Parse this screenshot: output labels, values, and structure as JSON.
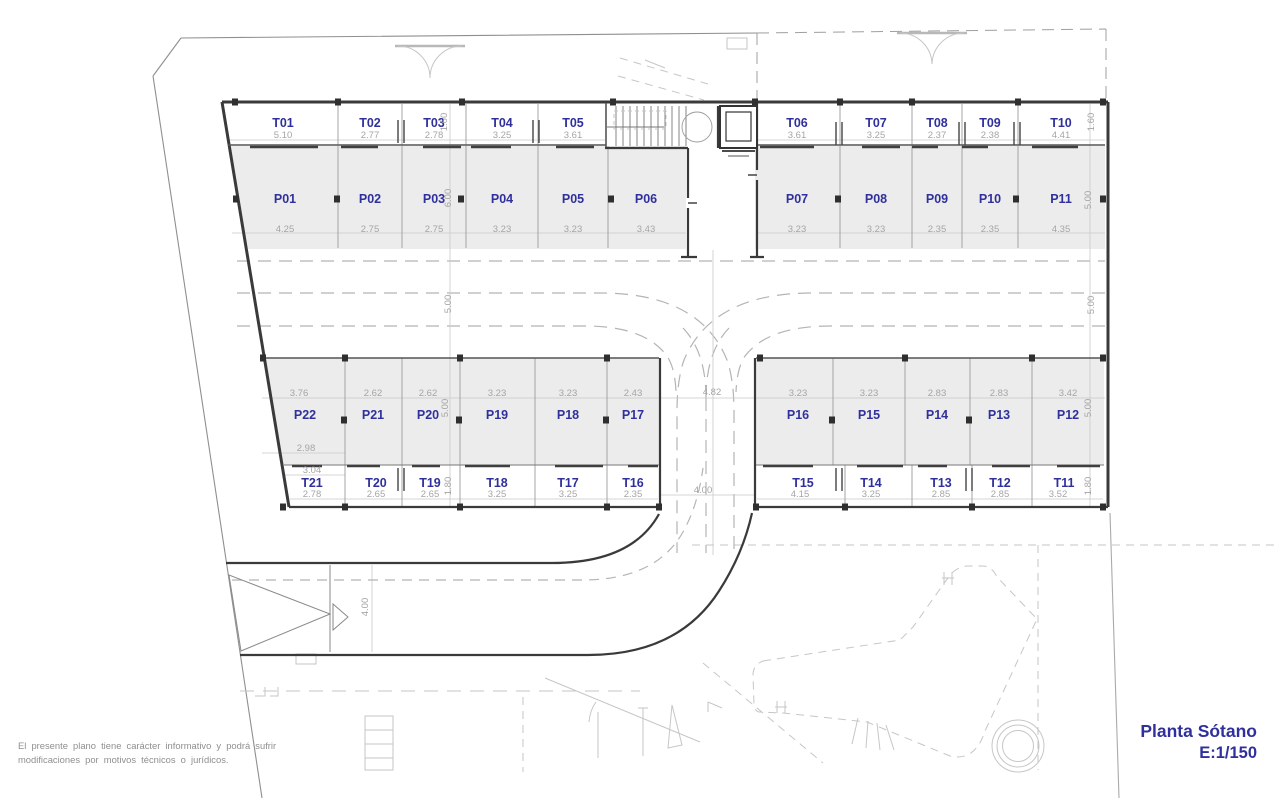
{
  "title_block": {
    "title": "Planta Sótano",
    "scale": "E:1/150"
  },
  "disclaimer": {
    "line1": "El presente plano tiene carácter informativo y podrá sufrir",
    "line2": "modificaciones por motivos técnicos o jurídicos."
  },
  "colors": {
    "label_blue": "#30309c",
    "dim_gray": "#a5a5a5",
    "wall_dark": "#3a3a3a",
    "stall_fill": "#ececec",
    "line_gray": "#9c9c9c",
    "light_gray": "#c6c6c6"
  },
  "plan": {
    "rows": [
      {
        "name": "storage-top",
        "label_y": 127,
        "dim_y": 138,
        "stalls": [
          {
            "id": "T01",
            "dim": "5.10",
            "x": 283
          },
          {
            "id": "T02",
            "dim": "2.77",
            "x": 370
          },
          {
            "id": "T03",
            "dim": "2.78",
            "x": 434
          },
          {
            "id": "T04",
            "dim": "3.25",
            "x": 502
          },
          {
            "id": "T05",
            "dim": "3.61",
            "x": 573
          },
          {
            "id": "T06",
            "dim": "3.61",
            "x": 797
          },
          {
            "id": "T07",
            "dim": "3.25",
            "x": 876
          },
          {
            "id": "T08",
            "dim": "2.37",
            "x": 937
          },
          {
            "id": "T09",
            "dim": "2.38",
            "x": 990
          },
          {
            "id": "T10",
            "dim": "4.41",
            "x": 1061
          }
        ]
      },
      {
        "name": "parking-top",
        "label_y": 203,
        "dim_y": 232,
        "stalls": [
          {
            "id": "P01",
            "dim": "4.25",
            "x": 285
          },
          {
            "id": "P02",
            "dim": "2.75",
            "x": 370
          },
          {
            "id": "P03",
            "dim": "2.75",
            "x": 434
          },
          {
            "id": "P04",
            "dim": "3.23",
            "x": 502
          },
          {
            "id": "P05",
            "dim": "3.23",
            "x": 573
          },
          {
            "id": "P06",
            "dim": "3.43",
            "x": 646
          },
          {
            "id": "P07",
            "dim": "3.23",
            "x": 797
          },
          {
            "id": "P08",
            "dim": "3.23",
            "x": 876
          },
          {
            "id": "P09",
            "dim": "2.35",
            "x": 937
          },
          {
            "id": "P10",
            "dim": "2.35",
            "x": 990
          },
          {
            "id": "P11",
            "dim": "4.35",
            "x": 1061
          }
        ]
      },
      {
        "name": "parking-bottom",
        "label_y": 419,
        "dim_y": 396,
        "stalls": [
          {
            "id": "P22",
            "dim": "3.76",
            "x": 305,
            "dim_x": 299
          },
          {
            "id": "P21",
            "dim": "2.62",
            "x": 373
          },
          {
            "id": "P20",
            "dim": "2.62",
            "x": 428
          },
          {
            "id": "P19",
            "dim": "3.23",
            "x": 497
          },
          {
            "id": "P18",
            "dim": "3.23",
            "x": 568
          },
          {
            "id": "P17",
            "dim": "2.43",
            "x": 633
          },
          {
            "id": "P16",
            "dim": "3.23",
            "x": 798
          },
          {
            "id": "P15",
            "dim": "3.23",
            "x": 869
          },
          {
            "id": "P14",
            "dim": "2.83",
            "x": 937
          },
          {
            "id": "P13",
            "dim": "2.83",
            "x": 999
          },
          {
            "id": "P12",
            "dim": "3.42",
            "x": 1068
          }
        ]
      },
      {
        "name": "storage-bottom",
        "label_y": 487,
        "dim_y": 497,
        "stalls": [
          {
            "id": "T21",
            "dim": "2.78",
            "x": 312
          },
          {
            "id": "T20",
            "dim": "2.65",
            "x": 376
          },
          {
            "id": "T19",
            "dim": "2.65",
            "x": 430
          },
          {
            "id": "T18",
            "dim": "3.25",
            "x": 497
          },
          {
            "id": "T17",
            "dim": "3.25",
            "x": 568
          },
          {
            "id": "T16",
            "dim": "2.35",
            "x": 633
          },
          {
            "id": "T15",
            "dim": "4.15",
            "x": 803,
            "dim_x": 800
          },
          {
            "id": "T14",
            "dim": "3.25",
            "x": 871
          },
          {
            "id": "T13",
            "dim": "2.85",
            "x": 941
          },
          {
            "id": "T12",
            "dim": "2.85",
            "x": 1000
          },
          {
            "id": "T11",
            "dim": "3.52",
            "x": 1064,
            "dim_x": 1058
          }
        ]
      }
    ],
    "dim_labels": [
      {
        "t": "1.60",
        "x": 447,
        "y": 122,
        "r": 1
      },
      {
        "t": "6.00",
        "x": 451,
        "y": 198,
        "r": 1
      },
      {
        "t": "5.00",
        "x": 451,
        "y": 304,
        "r": 1
      },
      {
        "t": "5.00",
        "x": 448,
        "y": 408,
        "r": 1
      },
      {
        "t": "1.80",
        "x": 451,
        "y": 486,
        "r": 1
      },
      {
        "t": "1.60",
        "x": 1094,
        "y": 122,
        "r": 1
      },
      {
        "t": "5.00",
        "x": 1091,
        "y": 200,
        "r": 1
      },
      {
        "t": "5.00",
        "x": 1094,
        "y": 305,
        "r": 1
      },
      {
        "t": "5.00",
        "x": 1091,
        "y": 408,
        "r": 1
      },
      {
        "t": "1.80",
        "x": 1091,
        "y": 486,
        "r": 1
      },
      {
        "t": "4.00",
        "x": 368,
        "y": 607,
        "r": 1
      },
      {
        "t": "4.82",
        "x": 712,
        "y": 395
      },
      {
        "t": "4.00",
        "x": 703,
        "y": 493
      },
      {
        "t": "2.98",
        "x": 306,
        "y": 451
      },
      {
        "t": "3.04",
        "x": 312,
        "y": 473
      }
    ]
  }
}
